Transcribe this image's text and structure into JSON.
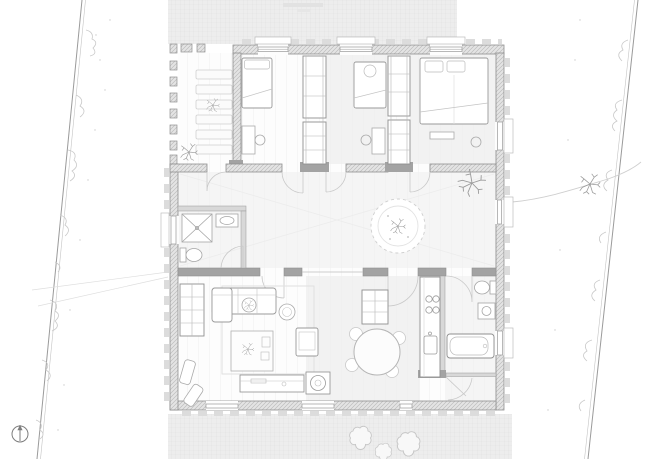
{
  "document": {
    "kind": "architectural-floor-plan",
    "sheet": "single-storey house plan with site boundaries and terraces",
    "visible_text": "none (only an illegible faint stamp at top edge of upper terrace)"
  },
  "colors": {
    "paper": "#ffffff",
    "terrace_fill": "#ededed",
    "terrace_grid": "#e0e0e0",
    "wall_fill": "#e4e4e4",
    "wall_hatch": "#bdbdbd",
    "wall_outline": "#8f8f8f",
    "wall_dark_cap": "#a3a3a3",
    "furniture_line": "#9a9a9a",
    "light_line": "#c9c9c9",
    "floor_tint": "#f3f3f3",
    "vegetation": "#c6c6c6"
  },
  "site": {
    "north_arrow": "compass-north-icon (circle with needle, lower left)",
    "boundary_left": "double survey line with shrub scallops, slanting",
    "boundary_right": "double survey line with shrub scallops, slanting",
    "upper_terrace": "paved grid terrace above house",
    "lower_terrace": "paved grid terrace below house with three shrubs",
    "garden_path": "curved line from east door to right boundary",
    "trees": [
      "large tree at east door",
      "small tree near right boundary"
    ],
    "watermark": "illegible faint stamp"
  },
  "plan": {
    "areas": [
      {
        "name": "covered-porch",
        "features": [
          "column row",
          "deck slats",
          "potted plant"
        ]
      },
      {
        "name": "bedroom-1",
        "features": [
          "single bed",
          "desk",
          "chair"
        ]
      },
      {
        "name": "wardrobe-1",
        "features": [
          "shelved closet unit"
        ]
      },
      {
        "name": "bedroom-2",
        "features": [
          "single bed",
          "desk",
          "chair"
        ]
      },
      {
        "name": "wardrobe-2",
        "features": [
          "shelved closet unit"
        ]
      },
      {
        "name": "bedroom-3",
        "features": [
          "double bed",
          "bench"
        ]
      },
      {
        "name": "hall",
        "features": [
          "round planter with tree",
          "indoor tree at east door"
        ]
      },
      {
        "name": "shower-room",
        "features": [
          "shower",
          "washbasin",
          "toilet"
        ]
      },
      {
        "name": "living-room",
        "features": [
          "corner sofa",
          "side table",
          "round chair",
          "armchair",
          "coffee table with plant",
          "rug",
          "tv bench",
          "stove/fireplace",
          "bookshelf",
          "two lounge chairs"
        ]
      },
      {
        "name": "dining-area",
        "features": [
          "round table",
          "chairs",
          "tall cabinet"
        ]
      },
      {
        "name": "kitchen",
        "features": [
          "counter",
          "cooktop",
          "sink"
        ]
      },
      {
        "name": "bathroom",
        "features": [
          "toilet",
          "washbasin",
          "bathtub"
        ]
      },
      {
        "name": "rear-lobby",
        "features": [
          "door to lower terrace"
        ]
      }
    ]
  }
}
